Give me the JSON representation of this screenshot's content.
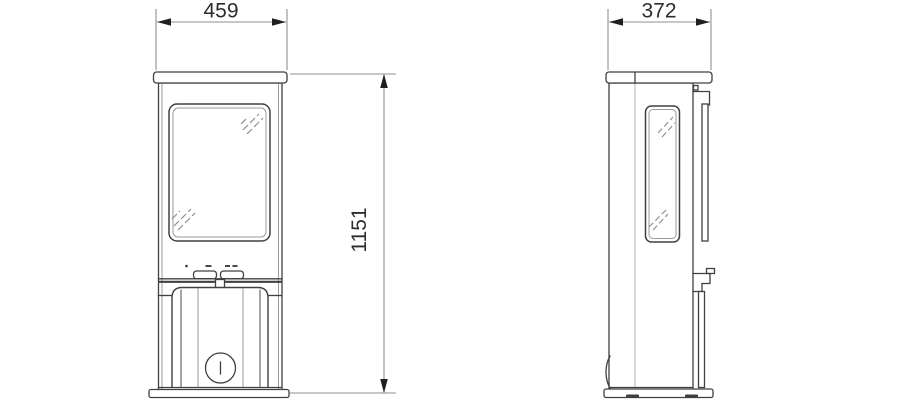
{
  "dimensions": {
    "width_front": "459",
    "depth_side": "372",
    "height": "1151"
  },
  "colors": {
    "background": "#ffffff",
    "outline": "#404040",
    "secondary_line": "#9a9a9a",
    "dimension_line": "#8f8f8f",
    "arrowhead": "#1f1f1f",
    "label_text": "#2d2d2d"
  }
}
